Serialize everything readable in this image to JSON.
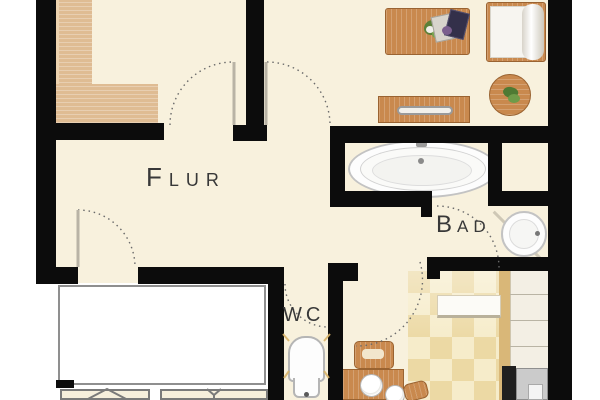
{
  "floorplan": {
    "rooms": {
      "hallway": {
        "label": "Flur"
      },
      "bathroom": {
        "label": "Bad"
      },
      "toilet_room": {
        "label": "WC"
      }
    },
    "furniture": [
      {
        "name": "l-shaped-wardrobe",
        "room": "top-left-room"
      },
      {
        "name": "dining-table-with-flowers-and-magazines",
        "room": "living-room"
      },
      {
        "name": "daybed-with-rolled-mattress",
        "room": "living-room"
      },
      {
        "name": "round-side-table-with-plant",
        "room": "living-room"
      },
      {
        "name": "sideboard-with-handle",
        "room": "living-room"
      },
      {
        "name": "bathtub",
        "room": "bathroom"
      },
      {
        "name": "corner-washbasin",
        "room": "bathroom"
      },
      {
        "name": "toilet",
        "room": "toilet-room"
      },
      {
        "name": "kitchen-counter",
        "room": "kitchen"
      },
      {
        "name": "stove-with-cooktop",
        "room": "kitchen"
      },
      {
        "name": "chair-and-table-with-plates",
        "room": "kitchen"
      },
      {
        "name": "white-rug",
        "room": "kitchen"
      },
      {
        "name": "terrace-furniture-chevron",
        "room": "outside-bottom"
      },
      {
        "name": "terrace-furniture-y",
        "room": "outside-bottom"
      }
    ],
    "colors": {
      "wall": "#0c0c0c",
      "floor_cream": "#f8f1dd",
      "wood_mid": "#c9894e",
      "wood_light": "#dfbc93",
      "tile_light": "#f6ecca",
      "tile_dark": "#ecd9a4",
      "fixture_white": "#fdfdfd",
      "outline_gray": "#8f8f8f",
      "door_arc": "#6a6a6a",
      "label_text": "#383838"
    }
  }
}
